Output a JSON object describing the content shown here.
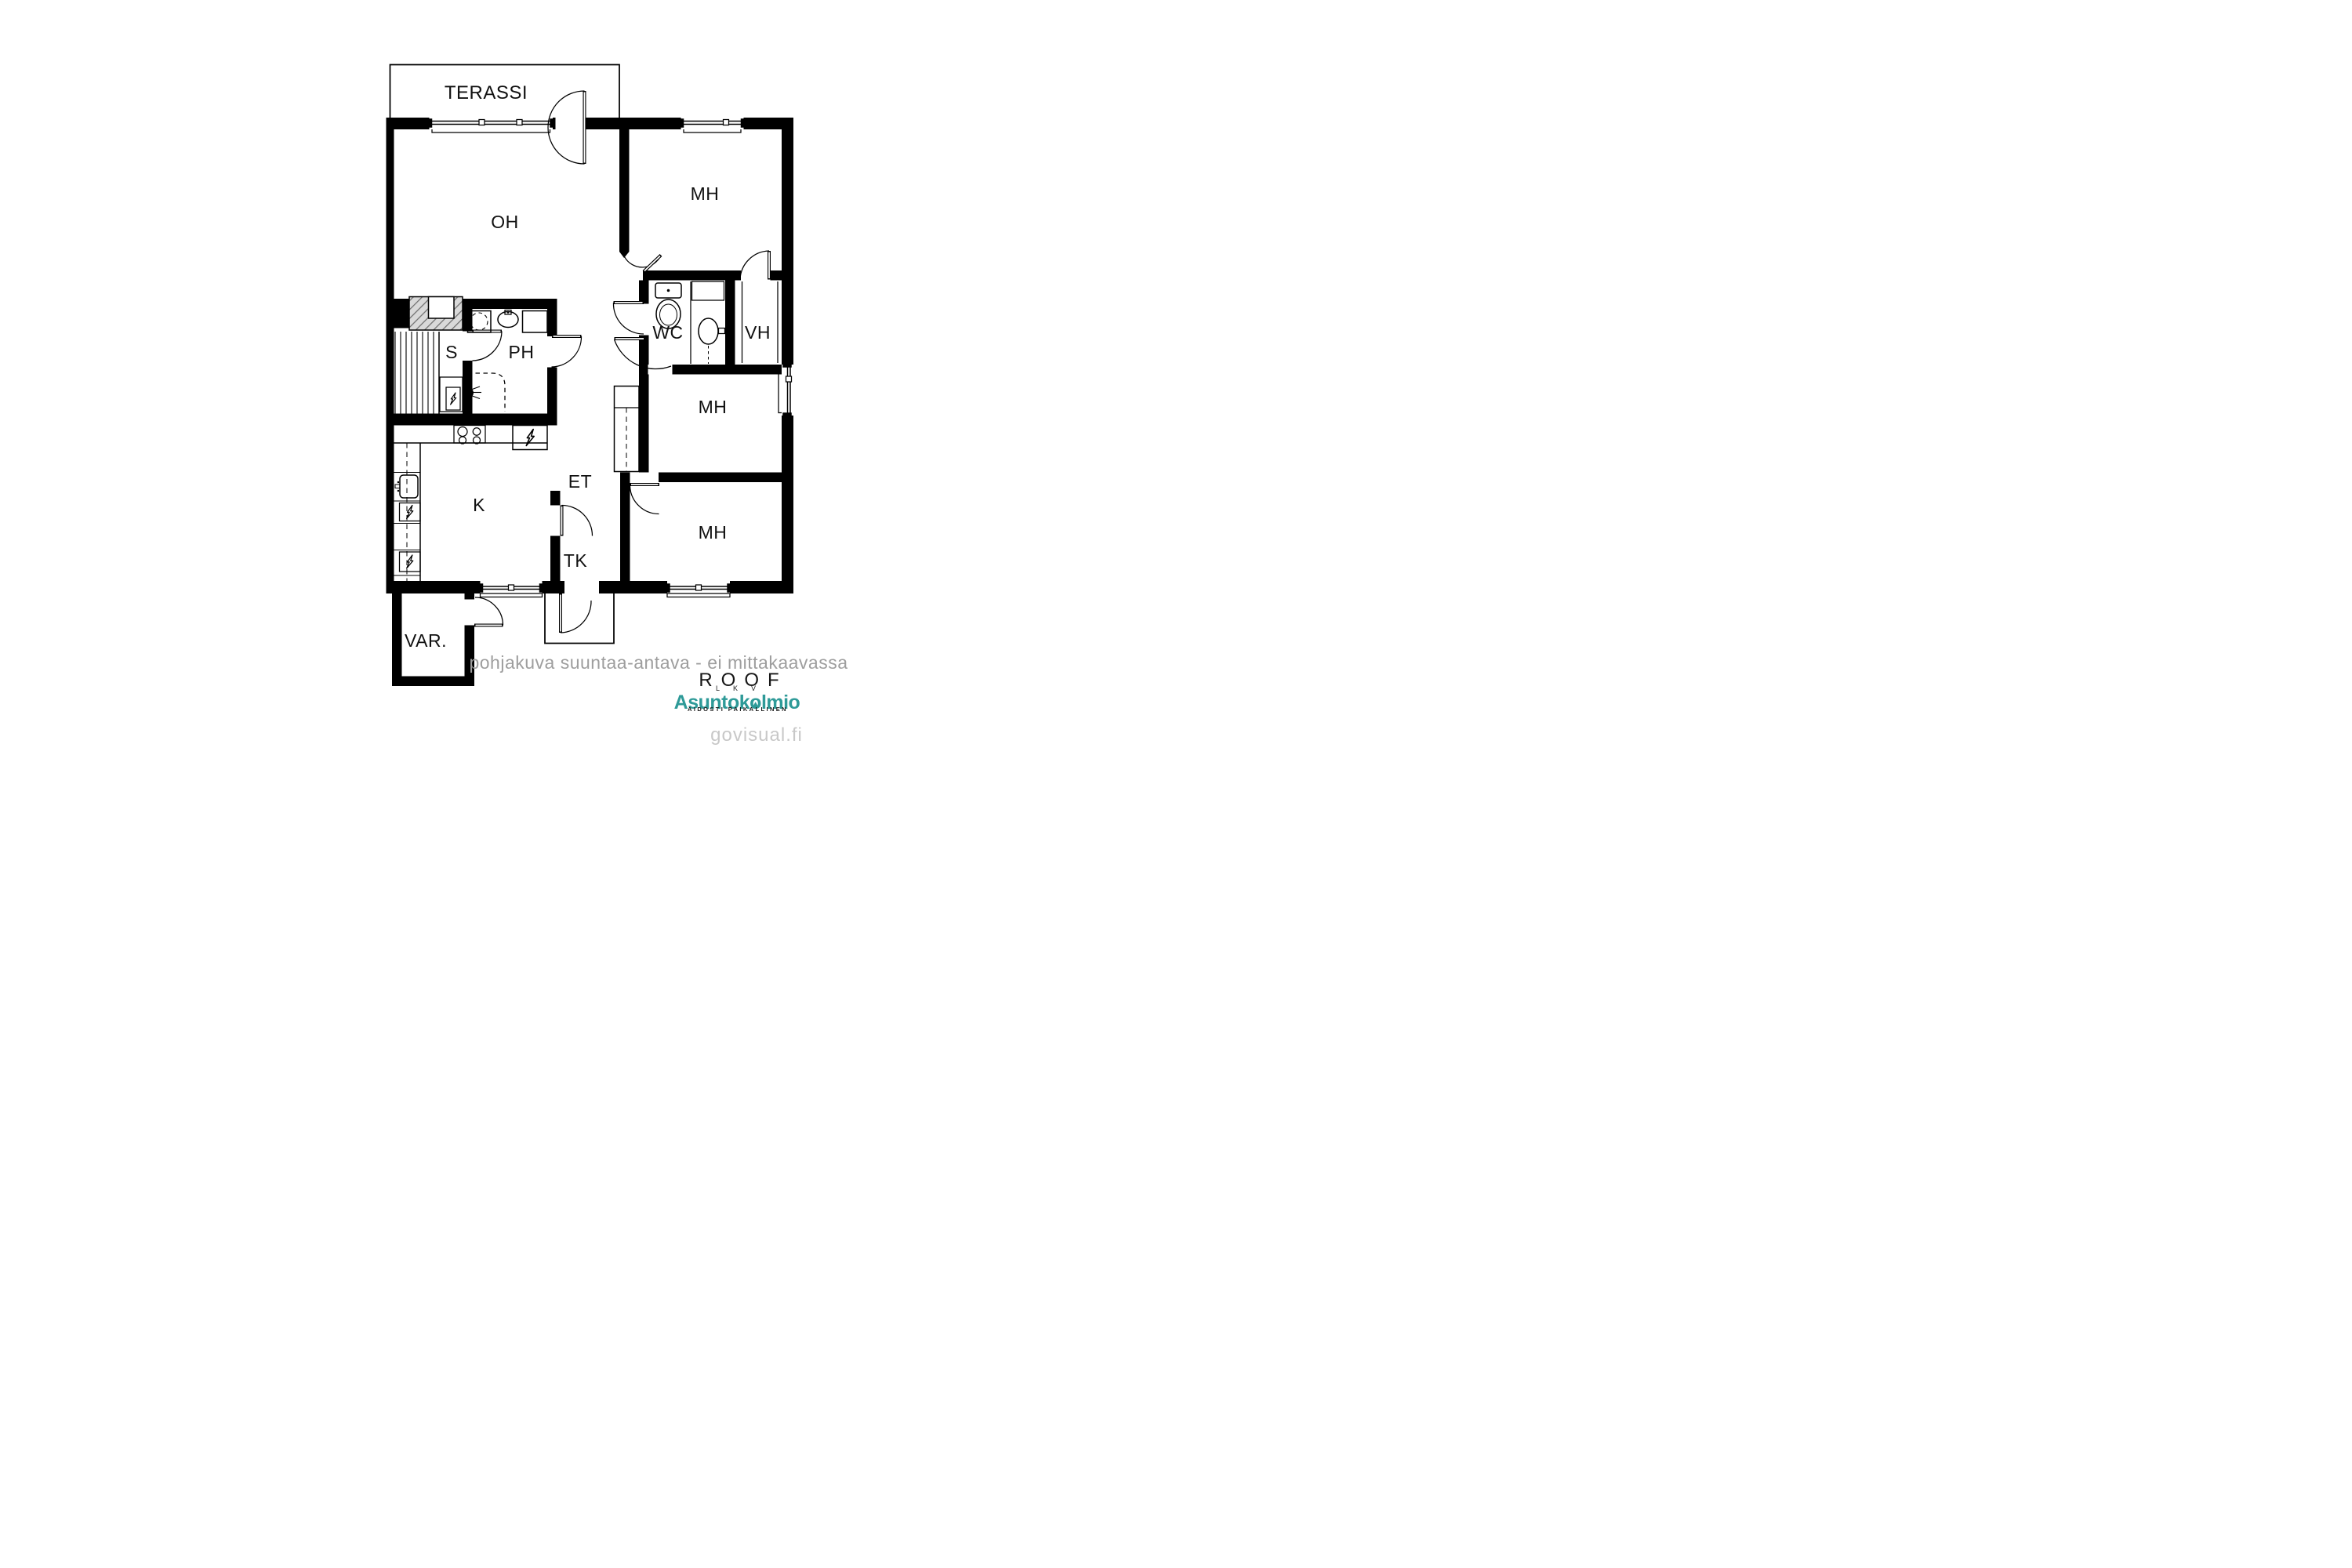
{
  "plan": {
    "rooms": {
      "terassi": "TERASSI",
      "oh": "OH",
      "mh": "MH",
      "wc": "WC",
      "vh": "VH",
      "s": "S",
      "ph": "PH",
      "k": "K",
      "et": "ET",
      "tk": "TK",
      "var": "VAR."
    },
    "icons": {
      "toilet": "toilet-icon",
      "wc_sink": "sink-icon",
      "ph_sink": "sink-icon",
      "washing_machine": "washing-machine-icon",
      "shower": "shower-icon",
      "sauna_stove": "sauna-stove-lightning-icon",
      "stove_burners": "stove-burners-icon",
      "fridge": "appliance-lightning-icon",
      "dishwasher": "appliance-lightning-icon",
      "kitchen_sink": "kitchen-sink-icon"
    }
  },
  "footer": {
    "disclaimer": "pohjakuva suuntaa-antava - ei mittakaavassa"
  },
  "branding": {
    "roof": {
      "name": "ROOF",
      "sub": "LKV"
    },
    "asuntokolmio": {
      "pre": "Asuntok",
      "o": "o",
      "post": "lmio",
      "tagline": "AIDOSTI PAIKALLINEN"
    },
    "watermark": "govisual.fi"
  },
  "colors": {
    "wall": "#000000",
    "hatch_fill": "#d9d9d9",
    "brand_teal": "#2e9a98",
    "disclaimer_gray": "#9e9e9e",
    "watermark_gray": "#c8c8c8"
  }
}
